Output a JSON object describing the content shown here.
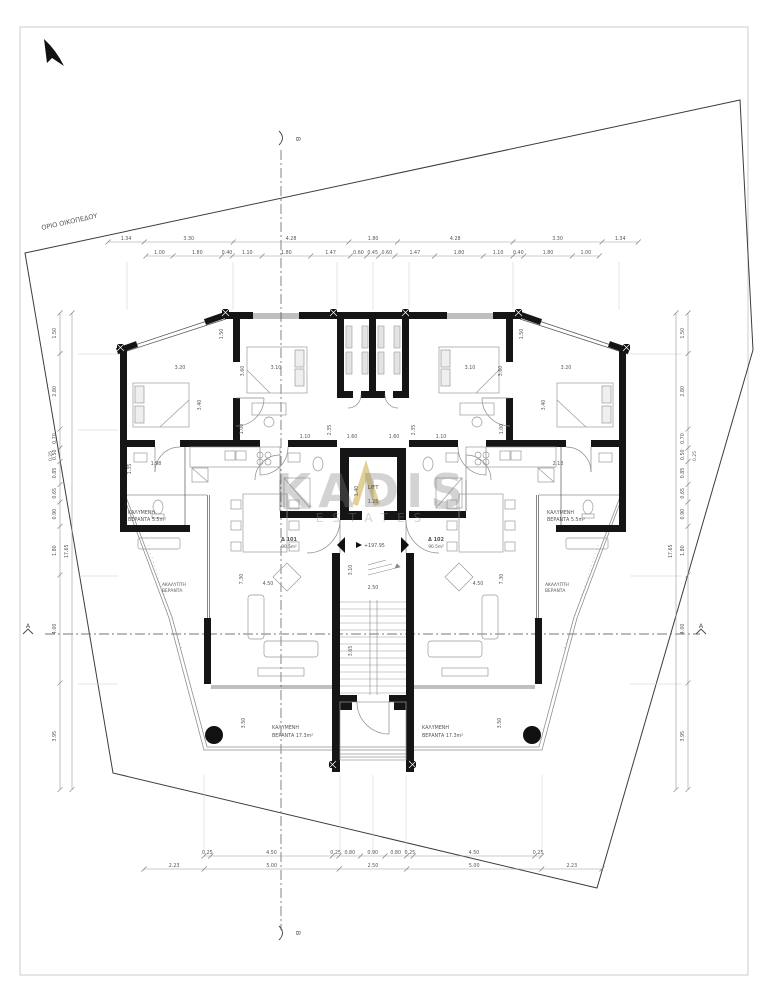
{
  "texts": {
    "plot_boundary": "ΟΡΙΟ ΟΙΚΟΠΕΔΟΥ",
    "lift": "LIFT",
    "level": "+197.95",
    "watermark_word": "KADIS",
    "watermark_sub": "ESTATES",
    "section_a": "A",
    "section_b": "B"
  },
  "apartments": [
    {
      "id": "Δ 101",
      "area": "90.5m²",
      "x": 289,
      "y": 541
    },
    {
      "id": "Δ 102",
      "area": "90.5m²",
      "x": 436,
      "y": 541
    }
  ],
  "dim_chains": [
    {
      "name": "top-row-1",
      "dir": "h",
      "x": 108,
      "y": 242,
      "scale": 27,
      "values": [
        1.34,
        3.3,
        4.28,
        1.8,
        4.28,
        3.3,
        1.34
      ]
    },
    {
      "name": "top-row-2",
      "dir": "h",
      "x": 146,
      "y": 256,
      "scale": 27,
      "values": [
        1.0,
        1.8,
        0.4,
        1.1,
        1.8,
        1.47,
        0.6,
        0.45,
        0.6,
        1.47,
        1.8,
        1.1,
        0.4,
        1.8,
        1.0
      ]
    },
    {
      "name": "bottom-row-1",
      "dir": "h",
      "x": 204,
      "y": 856,
      "scale": 27,
      "values": [
        0.25,
        4.5,
        0.25,
        0.8,
        0.9,
        0.8,
        0.25,
        4.5,
        0.25
      ]
    },
    {
      "name": "bottom-row-2",
      "dir": "h",
      "x": 144,
      "y": 869,
      "scale": 27,
      "values": [
        2.23,
        5.0,
        2.5,
        5.0,
        2.23
      ]
    },
    {
      "name": "left-outer",
      "dir": "v",
      "x": 60,
      "y": 313,
      "scale": 27,
      "values": [
        1.5,
        2.8,
        0.7,
        0.5,
        0.85,
        0.65,
        0.9,
        1.8,
        4.0,
        3.95
      ]
    },
    {
      "name": "left-inner",
      "dir": "v",
      "x": 72,
      "y": 313,
      "scale": 27,
      "values": [
        17.65
      ]
    },
    {
      "name": "right-outer",
      "dir": "v",
      "x": 688,
      "y": 313,
      "scale": 27,
      "values": [
        1.5,
        2.8,
        0.7,
        0.5,
        0.85,
        0.65,
        0.9,
        1.8,
        4.0,
        3.95
      ]
    },
    {
      "name": "right-inner",
      "dir": "v",
      "x": 676,
      "y": 313,
      "scale": 27,
      "values": [
        17.65
      ]
    }
  ],
  "floating_labels": [
    {
      "t": "3.20",
      "x": 180,
      "y": 369
    },
    {
      "t": "3.10",
      "x": 276,
      "y": 369
    },
    {
      "t": "3.60",
      "x": 244,
      "y": 371,
      "r": -90
    },
    {
      "t": "3.40",
      "x": 201,
      "y": 405,
      "r": -90
    },
    {
      "t": "1.50",
      "x": 223,
      "y": 334,
      "r": -90
    },
    {
      "t": "1.50",
      "x": 523,
      "y": 334,
      "r": -90
    },
    {
      "t": "3.10",
      "x": 470,
      "y": 369
    },
    {
      "t": "3.20",
      "x": 566,
      "y": 369
    },
    {
      "t": "3.60",
      "x": 502,
      "y": 371,
      "r": -90
    },
    {
      "t": "3.40",
      "x": 545,
      "y": 405,
      "r": -90
    },
    {
      "t": "1.00",
      "x": 243,
      "y": 429,
      "r": -90
    },
    {
      "t": "1.10",
      "x": 305,
      "y": 438
    },
    {
      "t": "2.35",
      "x": 331,
      "y": 430,
      "r": -90
    },
    {
      "t": "1.60",
      "x": 352,
      "y": 438
    },
    {
      "t": "1.60",
      "x": 394,
      "y": 438
    },
    {
      "t": "2.35",
      "x": 415,
      "y": 430,
      "r": -90
    },
    {
      "t": "1.10",
      "x": 441,
      "y": 438
    },
    {
      "t": "1.00",
      "x": 503,
      "y": 429,
      "r": -90
    },
    {
      "t": "1.98",
      "x": 156,
      "y": 465
    },
    {
      "t": "1.35",
      "x": 131,
      "y": 469,
      "r": -90
    },
    {
      "t": "2.13",
      "x": 558,
      "y": 465
    },
    {
      "t": "7.30",
      "x": 243,
      "y": 579,
      "r": -90
    },
    {
      "t": "4.50",
      "x": 268,
      "y": 585
    },
    {
      "t": "4.50",
      "x": 478,
      "y": 585
    },
    {
      "t": "7.30",
      "x": 503,
      "y": 579,
      "r": -90
    },
    {
      "t": "2.50",
      "x": 373,
      "y": 589
    },
    {
      "t": "3.10",
      "x": 352,
      "y": 570,
      "r": -90
    },
    {
      "t": "3.65",
      "x": 352,
      "y": 651,
      "r": -90
    },
    {
      "t": "3.50",
      "x": 245,
      "y": 723,
      "r": -90
    },
    {
      "t": "3.50",
      "x": 501,
      "y": 723,
      "r": -90
    },
    {
      "t": "1.40",
      "x": 358,
      "y": 491,
      "r": -90
    },
    {
      "t": "1.25",
      "x": 373,
      "y": 503
    },
    {
      "t": "0.25",
      "x": 52,
      "y": 456,
      "r": -90,
      "s": 4.5
    },
    {
      "t": "0.25",
      "x": 696,
      "y": 456,
      "r": -90,
      "s": 4.5
    },
    {
      "t": "ΚΑΛΥΜΕΝΗ",
      "x": 128,
      "y": 514,
      "a": "s",
      "cls": "greek"
    },
    {
      "t": "ΒΕΡΑΝΤΑ 5.5m²",
      "x": 128,
      "y": 521,
      "a": "s",
      "cls": "greek"
    },
    {
      "t": "ΚΑΛΥΜΕΝΗ",
      "x": 547,
      "y": 514,
      "a": "s",
      "cls": "greek"
    },
    {
      "t": "ΒΕΡΑΝΤΑ 5.5m²",
      "x": 547,
      "y": 521,
      "a": "s",
      "cls": "greek"
    },
    {
      "t": "ΑΚΑΛΥΠΤΗ",
      "x": 162,
      "y": 586,
      "a": "s",
      "s": 4.4,
      "cls": "greek"
    },
    {
      "t": "ΒΕΡΑΝΤΑ",
      "x": 162,
      "y": 592,
      "a": "s",
      "s": 4.4,
      "cls": "greek"
    },
    {
      "t": "ΑΚΑΛΥΠΤΗ",
      "x": 545,
      "y": 586,
      "a": "s",
      "s": 4.4,
      "cls": "greek"
    },
    {
      "t": "ΒΕΡΑΝΤΑ",
      "x": 545,
      "y": 592,
      "a": "s",
      "s": 4.4,
      "cls": "greek"
    },
    {
      "t": "ΚΑΛΥΜΕΝΗ",
      "x": 272,
      "y": 729,
      "a": "s",
      "cls": "greek"
    },
    {
      "t": "ΒΕΡΑΝΤΑ 17.3m²",
      "x": 272,
      "y": 737,
      "a": "s",
      "cls": "greek"
    },
    {
      "t": "ΚΑΛΥΜΕΝΗ",
      "x": 422,
      "y": 729,
      "a": "s",
      "cls": "greek"
    },
    {
      "t": "ΒΕΡΑΝΤΑ 17.3m²",
      "x": 422,
      "y": 737,
      "a": "s",
      "cls": "greek"
    },
    {
      "t": "ΟΡΙΟ ΟΙΚΟΠΕΔΟΥ",
      "x": 42,
      "y": 230,
      "r": -12.5,
      "a": "s",
      "s": 6.5,
      "cls": "bnd"
    },
    {
      "t": "LIFT",
      "x": 373,
      "y": 489,
      "s": 5.5,
      "cls": "room"
    },
    {
      "t": "+197.95",
      "x": 364,
      "y": 547,
      "a": "s",
      "s": 4.8
    },
    {
      "t": "A",
      "x": 28,
      "y": 628,
      "s": 6.5,
      "cls": "sec"
    },
    {
      "t": "A",
      "x": 701,
      "y": 628,
      "s": 6.5,
      "cls": "sec"
    },
    {
      "t": "B",
      "x": 296,
      "y": 139,
      "r": 90,
      "s": 6.5,
      "cls": "sec"
    },
    {
      "t": "B",
      "x": 296,
      "y": 933,
      "r": 90,
      "s": 6.5,
      "cls": "sec"
    }
  ]
}
